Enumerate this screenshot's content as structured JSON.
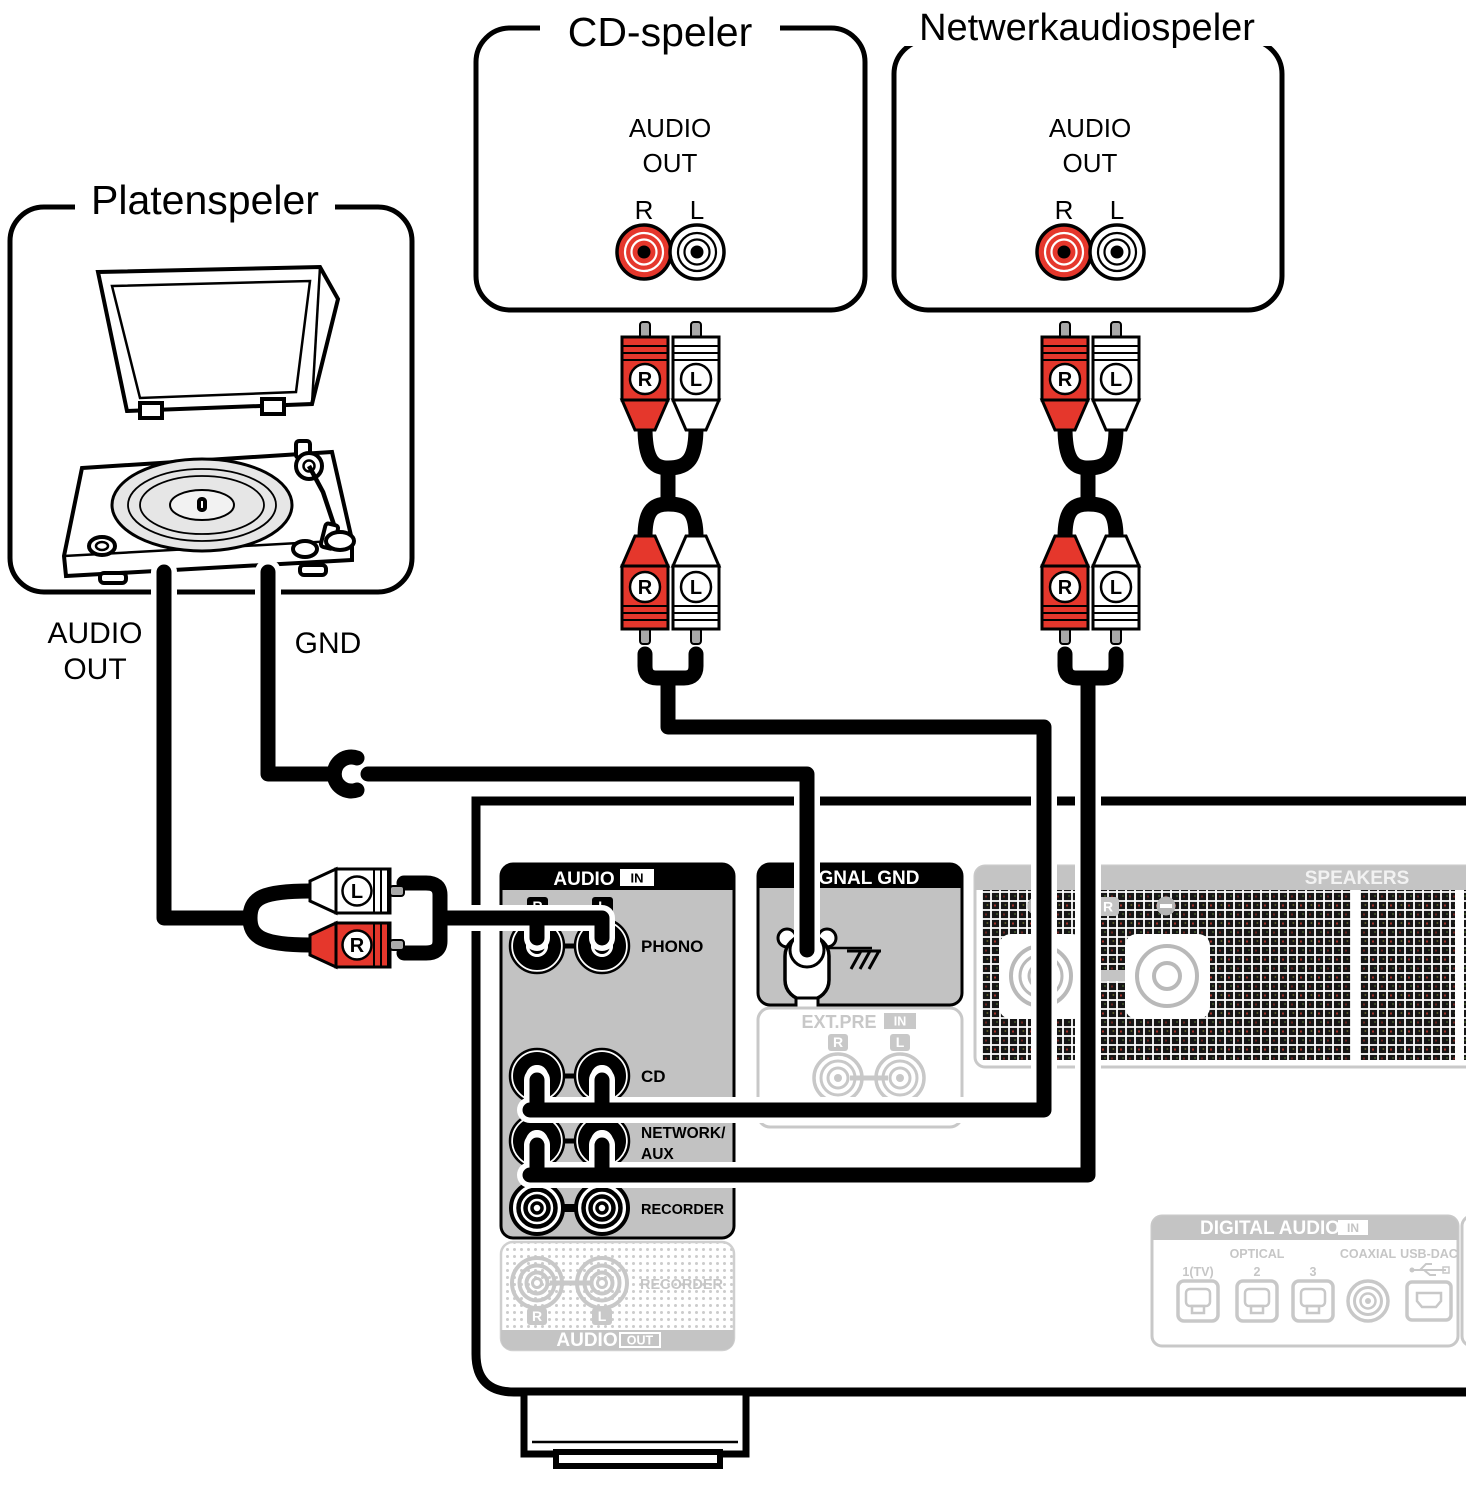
{
  "colors": {
    "accent_red": "#e5372c",
    "panel_gray": "#c2c2c2",
    "band_gray": "#c4c4c4",
    "disabled_gray": "#c8c8c8",
    "hatch_dark": "#161616"
  },
  "devices": {
    "turntable": {
      "title": "Platenspeler",
      "audio_out_line1": "AUDIO",
      "audio_out_line2": "OUT",
      "gnd_label": "GND"
    },
    "cd_player": {
      "title": "CD-speler",
      "label_line1": "AUDIO",
      "label_line2": "OUT",
      "right": "R",
      "left": "L"
    },
    "network_player": {
      "title": "Netwerkaudiospeler",
      "label_line1": "AUDIO",
      "label_line2": "OUT",
      "right": "R",
      "left": "L"
    }
  },
  "plugs": {
    "right": "R",
    "left": "L"
  },
  "amplifier": {
    "audio_in": {
      "header": "AUDIO",
      "header_badge": "IN",
      "right": "R",
      "left": "L",
      "rows": {
        "phono": "PHONO",
        "cd": "CD",
        "network_line1": "NETWORK/",
        "network_line2": "AUX",
        "recorder": "RECORDER"
      }
    },
    "signal_gnd": {
      "header": "SIGNAL GND"
    },
    "ext_pre": {
      "header": "EXT.PRE",
      "header_badge": "IN",
      "right": "R",
      "left": "L"
    },
    "speakers": {
      "header": "SPEAKERS",
      "right": "R"
    },
    "audio_out": {
      "recorder": "RECORDER",
      "right": "R",
      "left": "L",
      "footer": "AUDIO",
      "footer_badge": "OUT"
    },
    "digital_audio": {
      "header": "DIGITAL AUDIO",
      "header_badge": "IN",
      "optical": "OPTICAL",
      "input1": "1(TV)",
      "input2": "2",
      "input3": "3",
      "coaxial": "COAXIAL",
      "usb_dac": "USB-DAC"
    }
  }
}
